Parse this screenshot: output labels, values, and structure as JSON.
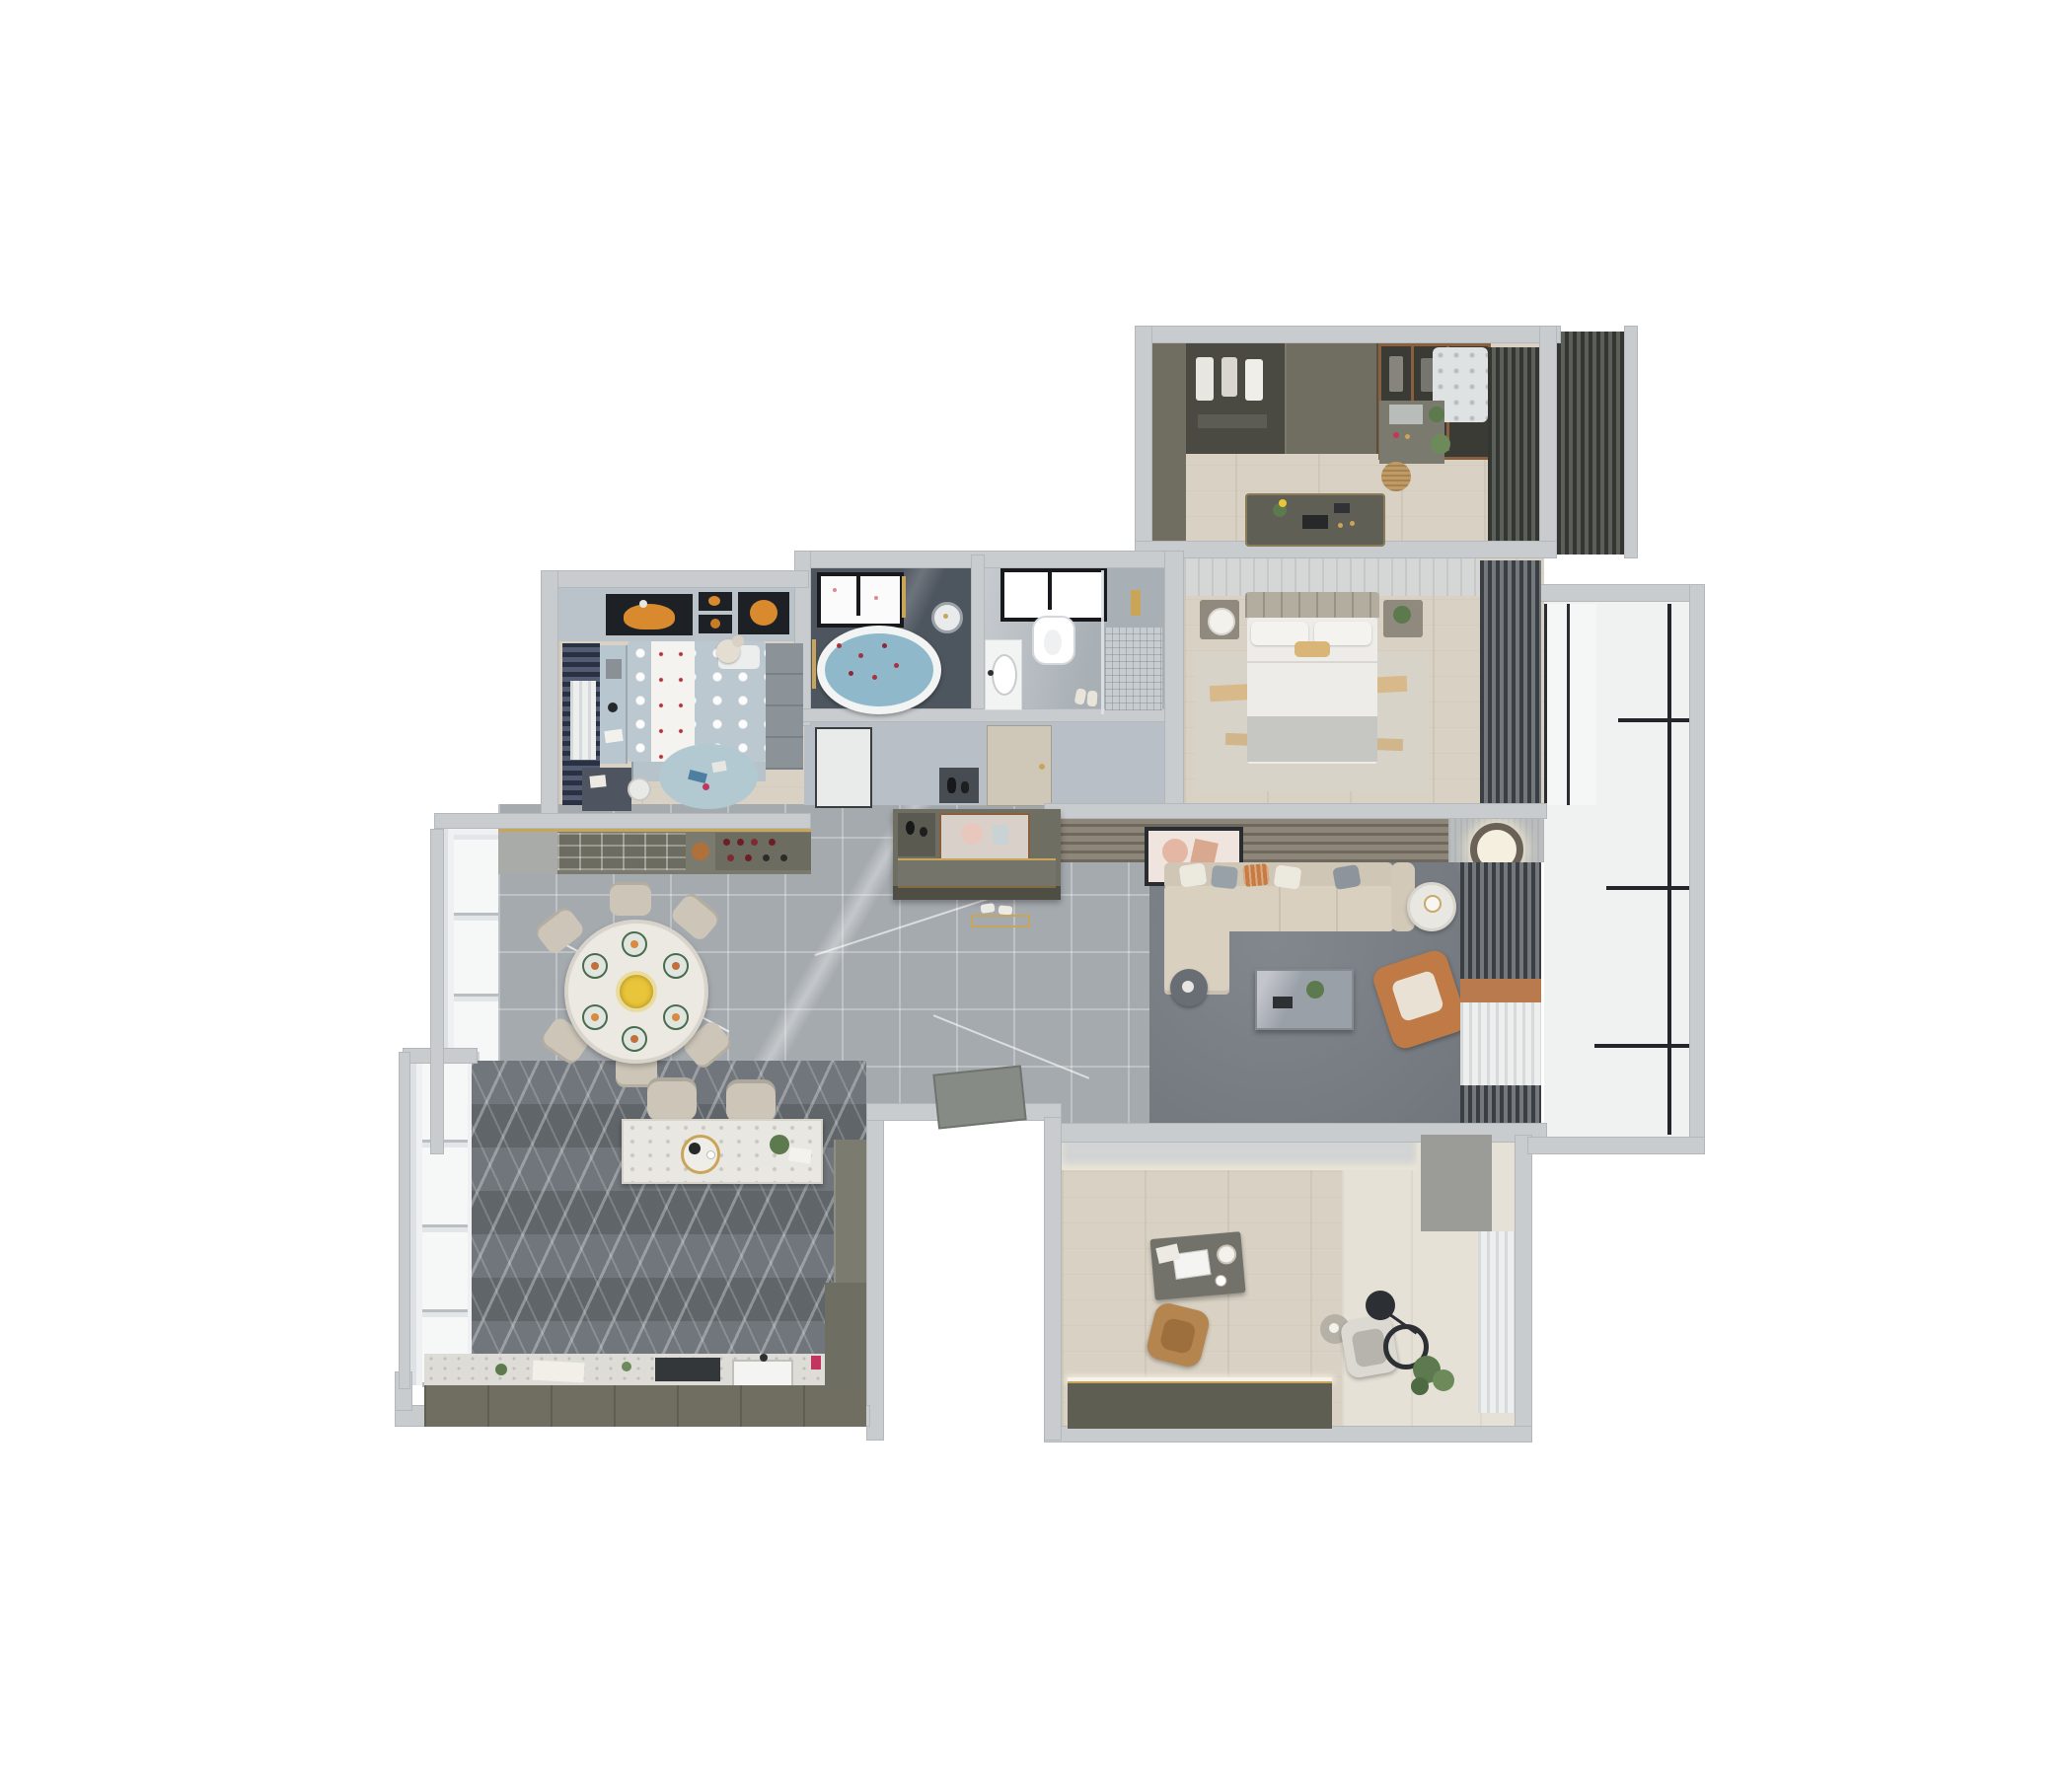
{
  "scene": {
    "kind": "3d-apartment-floorplan-top-view",
    "background": "#ffffff",
    "visible_text": "none"
  },
  "palette": {
    "outer_wall": "#c9cccf",
    "corridor_marble": "#a5aaaf",
    "kitchen_marble_dark": "#70767b",
    "wood_floor": "#d9d2c4",
    "olive_cabinetry": "#6f6e60",
    "sofa_beige": "#d9d0c0",
    "accent_orange": "#c07a45",
    "accent_gold": "#c9a55a",
    "bath_slate": "#4d555f",
    "kids_navy": "#3c4660",
    "rug_gray": "#7a8086",
    "bath_water_blue": "#8fb8ca"
  },
  "rooms": [
    {
      "label": "Walk-in closet",
      "furniture": [
        "wardrobe-wall",
        "glass-wardrobe",
        "island-dresser",
        "vanity-with-mirror",
        "rattan-basket",
        "corner-rug",
        "dark-curtains"
      ]
    },
    {
      "label": "Master bedroom",
      "furniture": [
        "double-bed",
        "headboard",
        "accent-pillow",
        "nightstand-lamp",
        "nightstand-plant",
        "area-rug-orange-streaks",
        "dark-curtains"
      ]
    },
    {
      "label": "Bathroom with tub",
      "furniture": [
        "oval-bathtub-petals",
        "window",
        "rain-shower-head",
        "gold-towel-rail",
        "door"
      ]
    },
    {
      "label": "Shower room",
      "furniture": [
        "wall-hung-toilet",
        "vanity-basin",
        "walk-in-shower",
        "gold-fixtures",
        "window",
        "slippers",
        "door"
      ]
    },
    {
      "label": "Kids bedroom",
      "furniture": [
        "polka-dot-bed",
        "teddy-bear",
        "planet-artwork",
        "navy-curtains",
        "desk",
        "drawer-chest",
        "wardrobe",
        "round-play-rug"
      ]
    },
    {
      "label": "Dining room",
      "furniture": [
        "round-dining-table",
        "six-chairs",
        "place-settings",
        "flower-centerpiece",
        "wine-sideboard",
        "floor-windows"
      ]
    },
    {
      "label": "Living room",
      "furniture": [
        "l-shaped-sofa",
        "throw-pillows",
        "marble-coffee-table",
        "orange-armchair",
        "white-side-table",
        "dark-side-table",
        "leaning-artwork",
        "wood-slat-tv-wall",
        "ring-ceiling-light",
        "gray-rug",
        "curtains"
      ]
    },
    {
      "label": "Kitchen",
      "furniture": [
        "island-bar",
        "two-bar-chairs",
        "tea-tray",
        "counter-run",
        "sink",
        "cooktop",
        "herringbone-floor",
        "windows"
      ]
    },
    {
      "label": "Study",
      "furniture": [
        "desk-with-laptop",
        "desk-lamp",
        "cognac-office-chair",
        "lounge-chair",
        "arc-floor-lamp",
        "side-table",
        "potted-plant",
        "low-cabinet",
        "sheer-curtains"
      ]
    },
    {
      "label": "Balcony",
      "furniture": [
        "white-tile-floor",
        "black-framed-glazing"
      ]
    },
    {
      "label": "Entry foyer",
      "furniture": [
        "shoe-console-with-mirror",
        "slippers",
        "gold-doormat-strip",
        "entry-door"
      ]
    },
    {
      "label": "Hallway",
      "furniture": [
        "marble-tiles",
        "interior-doors",
        "decor-niche"
      ]
    }
  ]
}
